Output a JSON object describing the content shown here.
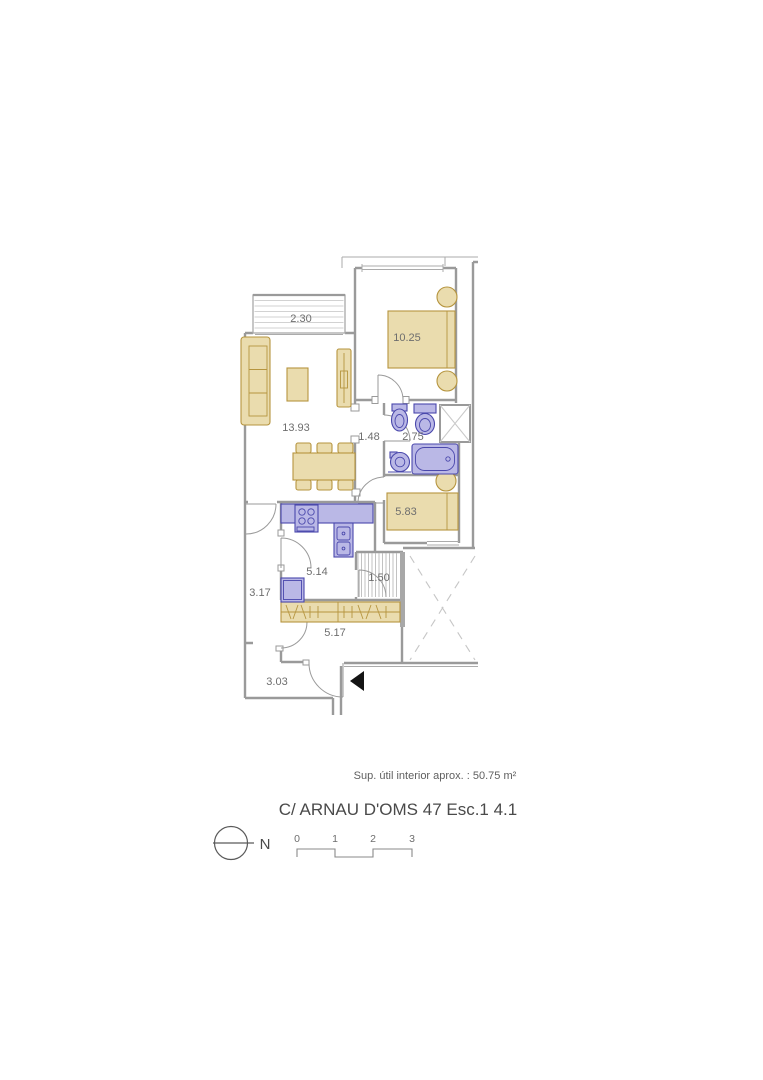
{
  "plan": {
    "rooms": {
      "balcony": {
        "area": "2.30"
      },
      "living_room": {
        "area": "13.93"
      },
      "main_bedroom": {
        "area": "10.25"
      },
      "hallway": {
        "area": "1.48"
      },
      "bathroom": {
        "area": "2.75"
      },
      "second_bedroom": {
        "area": "5.83"
      },
      "kitchen": {
        "area": "5.14"
      },
      "corridor": {
        "area": "3.17"
      },
      "stair_closet": {
        "area": "1.50"
      },
      "wardrobe_hall": {
        "area": "5.17"
      },
      "entry_hall": {
        "area": "3.03"
      }
    }
  },
  "footer": {
    "area_note": "Sup. útil interior aprox. : 50.75 m²",
    "title": "C/ ARNAU D'OMS 47 Esc.1 4.1",
    "north_label": "N",
    "scale_ticks": [
      "0",
      "1",
      "2",
      "3"
    ]
  },
  "colors": {
    "furniture_fill": "#eadcae",
    "furniture_stroke": "#b6953f",
    "fixture_fill": "#bab8e6",
    "fixture_stroke": "#4a48ac",
    "wall": "#9a9a9a",
    "label_text": "#6e6e6e",
    "title_text": "#4a4a4a",
    "entrance_marker": "#141414"
  }
}
